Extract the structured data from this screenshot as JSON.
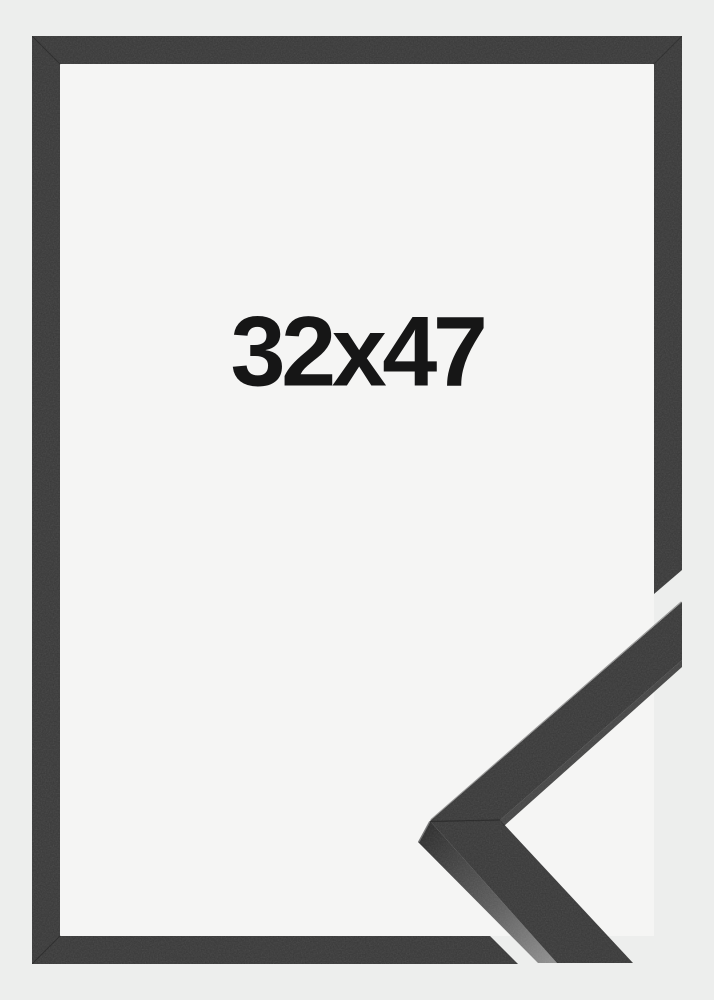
{
  "product": {
    "size_label": "32x47",
    "colors": {
      "outer_background": "#edeeed",
      "inner_background": "#f5f5f4",
      "frame": "#373737",
      "frame_inner_edge": "#242424",
      "profile_side_dark": "#2b2b2b",
      "profile_side_mid": "#5a5a5a",
      "profile_side_light": "#8f8f8f",
      "label_text": "#161616"
    }
  }
}
